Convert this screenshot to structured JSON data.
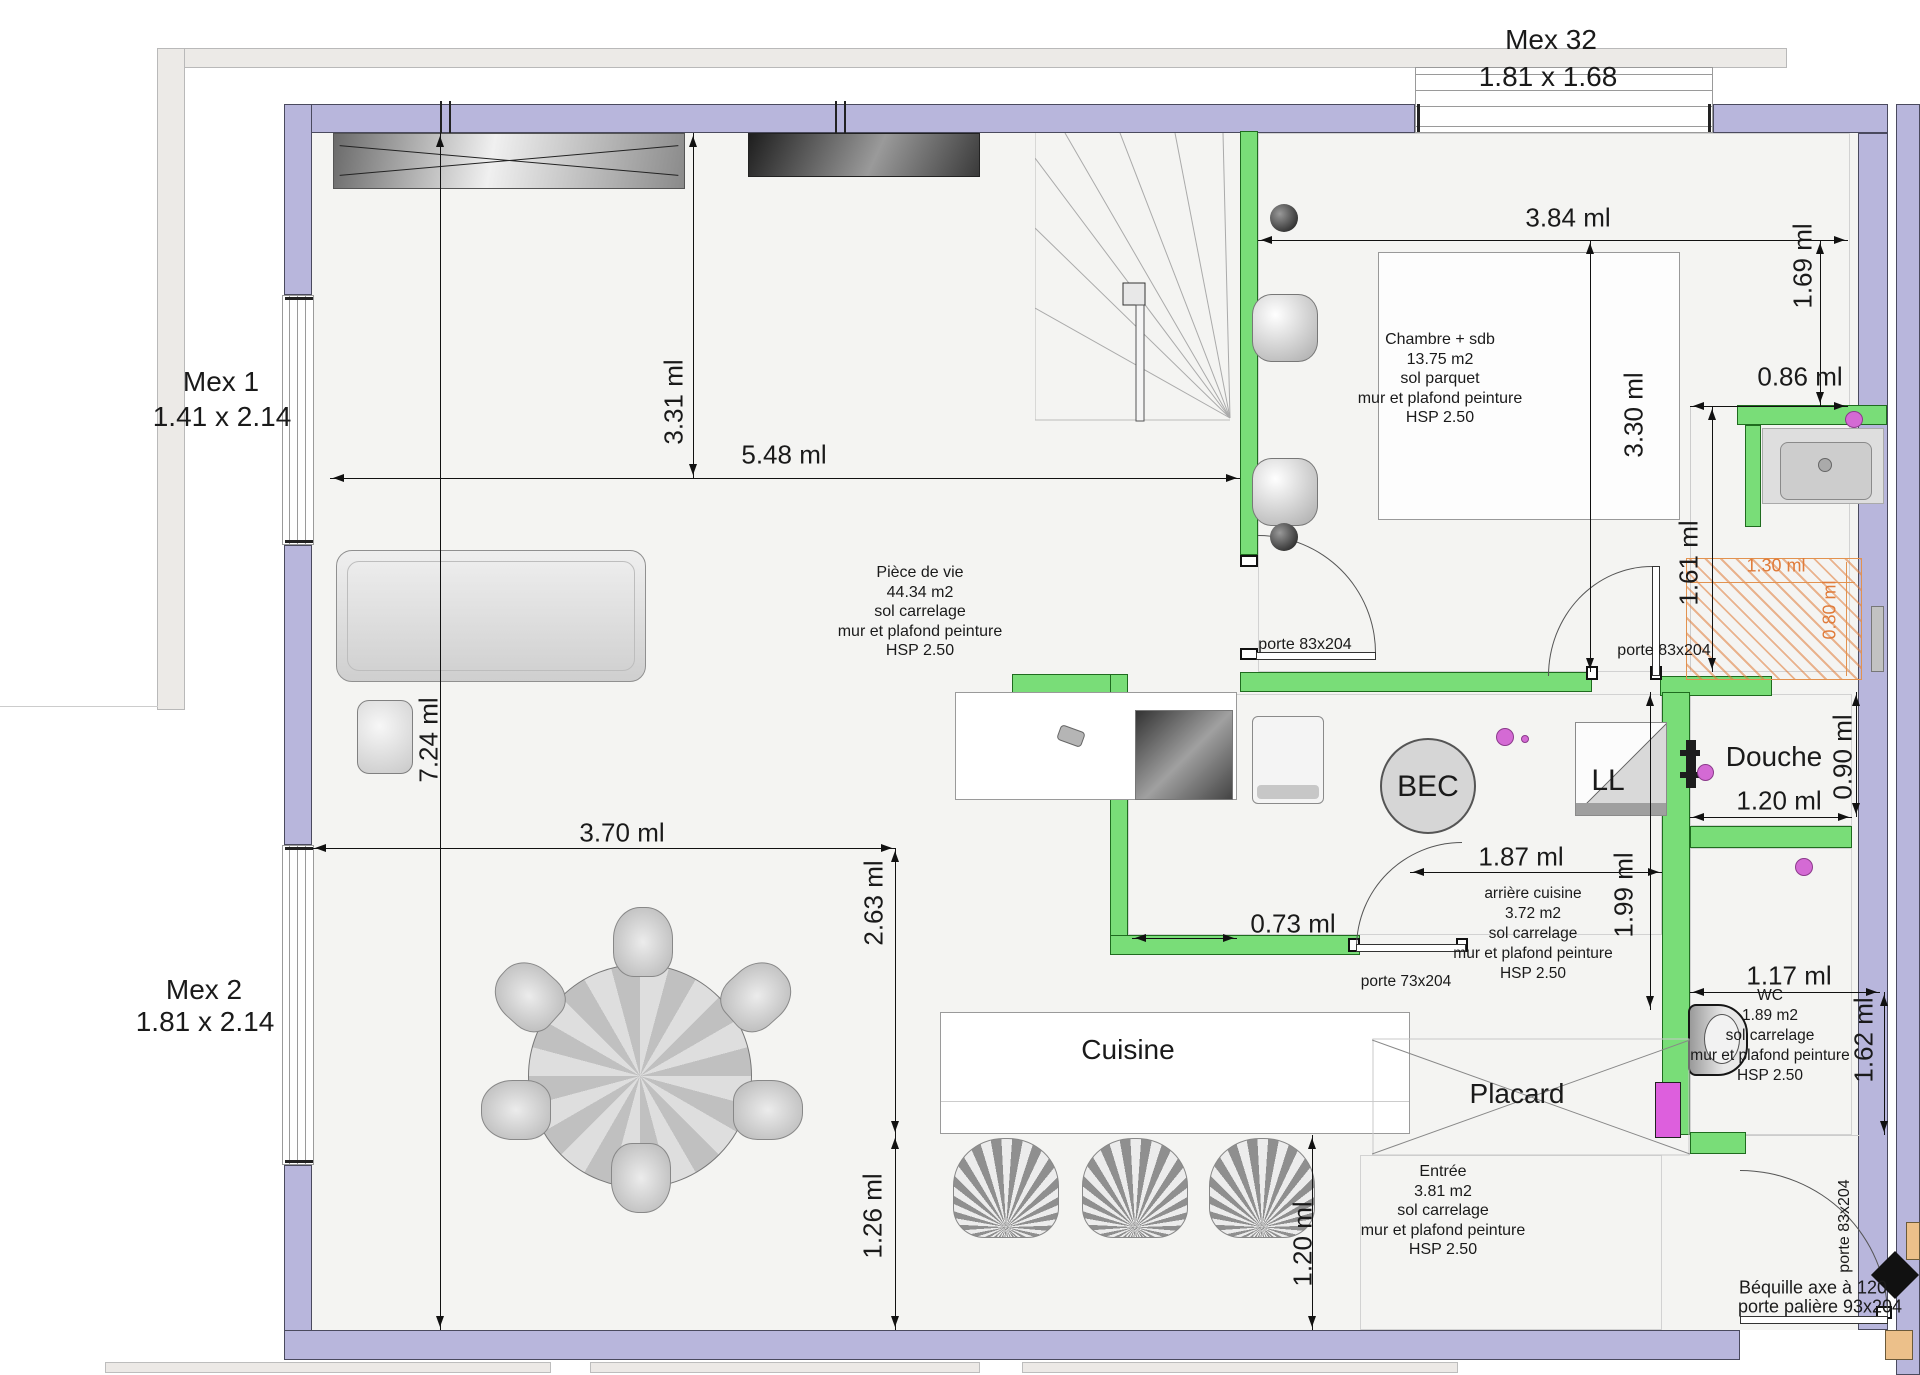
{
  "windows": {
    "mex32": {
      "label": "Mex 32",
      "size": "1.81 x 1.68"
    },
    "mex1": {
      "label": "Mex 1",
      "size": "1.41 x 2.14"
    },
    "mex2": {
      "label": "Mex 2",
      "size": "1.81 x 2.14"
    }
  },
  "rooms": {
    "chambre": {
      "name": "Chambre + sdb",
      "area": "13.75 m2",
      "floor": "sol parquet",
      "finish": "mur et plafond peinture",
      "height": "HSP 2.50"
    },
    "piece_de_vie": {
      "name": "Pièce de vie",
      "area": "44.34 m2",
      "floor": "sol carrelage",
      "finish": "mur et plafond peinture",
      "height": "HSP 2.50"
    },
    "arriere_cuisine": {
      "name": "arrière cuisine",
      "area": "3.72 m2",
      "floor": "sol carrelage",
      "finish": "mur et plafond peinture",
      "height": "HSP 2.50"
    },
    "wc": {
      "name": "WC",
      "area": "1.89 m2",
      "floor": "sol carrelage",
      "finish": "mur et plafond peinture",
      "height": "HSP 2.50"
    },
    "entree": {
      "name": "Entrée",
      "area": "3.81 m2",
      "floor": "sol carrelage",
      "finish": "mur et plafond peinture",
      "height": "HSP 2.50"
    }
  },
  "zones": {
    "cuisine": "Cuisine",
    "placard": "Placard",
    "douche": "Douche",
    "bec": "BEC",
    "lave_linge": "LL"
  },
  "dims": {
    "d384": "3.84 ml",
    "d169": "1.69 ml",
    "d086": "0.86 ml",
    "d330": "3.30 ml",
    "d161": "1.61 ml",
    "d548": "5.48 ml",
    "d331": "3.31 ml",
    "d724": "7.24 ml",
    "d370": "3.70 ml",
    "d263": "2.63 ml",
    "d126": "1.26 ml",
    "d073": "0.73 ml",
    "d187": "1.87 ml",
    "d199": "1.99 ml",
    "d120_douche": "1.20 ml",
    "d090": "0.90 ml",
    "d117": "1.17 ml",
    "d162": "1.62 ml",
    "d120_entree": "1.20 ml",
    "d130_shower": "1.30 ml",
    "d080_shower": "0.80 ml"
  },
  "doors": {
    "chambre": "porte 83x204",
    "sdb": "porte 83x204",
    "arriere_cuisine": "porte 73x204",
    "palier": "porte 83x204",
    "bequille_line1": "Béquille axe à 120",
    "bequille_line2": "porte palière 93x204"
  },
  "colors": {
    "wall_exterior": "#b8b6dc",
    "wall_interior": "#79dd78",
    "shower_hatch": "#e07b39",
    "fixture_pink": "#d46ad4"
  }
}
